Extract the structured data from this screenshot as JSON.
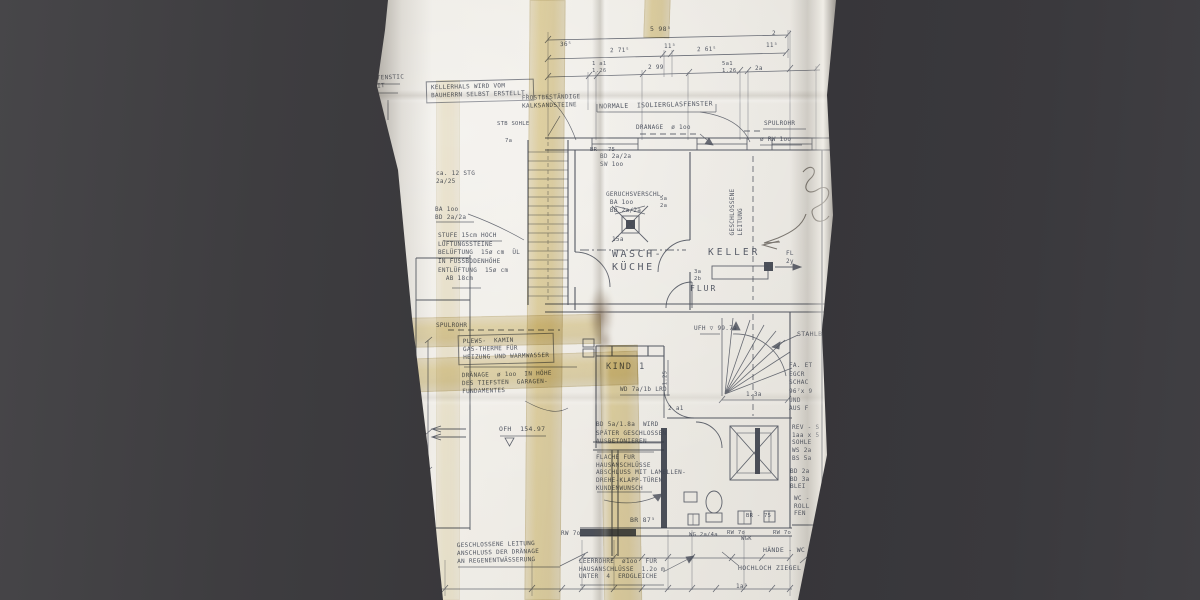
{
  "colors": {
    "backdrop": "#3a393c",
    "paper": "#e6e3dc",
    "tape": "#d2b36e",
    "ink": "#434855",
    "pencil": "#57514a"
  },
  "labels": {
    "kellerhals_note": "KELLERHALS WIRD VOM\nBAUHERRN SELBST ERSTELLT.",
    "edge_fragment": "TENSTIC\nIT",
    "frost_note": "FROSTBESTÄNDIGE\nKALKSANDSTEINE",
    "fenster_note": "NORMALE  ISOLIERGLASFENSTER",
    "drainage_top": "DRÄNAGE  ø 1oo",
    "spuelrohr_right": "SPÜLROHR",
    "rw100": "ø RW 1oo",
    "bd_sw": "BD 2a/2a\nSW 1oo",
    "br75_top": "BR - 75",
    "stg_note": "ca. 12 STG\n2a/25",
    "ba_bd": "BA 1oo\nBD 2a/2a",
    "stufe_note": "STUFE 15cm HOCH\nLÜFTUNGSSTEINE\nBELÜFTUNG  15ø cm  ÜL\nIN FUSSBODENHÖHE\nENTLÜFTUNG  15ø cm\n  AB 18cm",
    "geruch_note": "GERUCHSVERSCHL.\n BA 1oo\n BD 2a/2a",
    "sohle": "STB SOHLE",
    "dim_7a": "7a",
    "dim_15a": "15a",
    "wasch": "WASCH-\nKÜCHE",
    "keller": "KELLER",
    "geschl_leitung": "GESCHLOSSENE\nLEITUNG",
    "small_5a2a": "5a\n2a",
    "fl2y": "FL\n2y",
    "small_3a2b": "3a\n2b",
    "flur": "FLUR",
    "ufh": "UFH ▽ 99.7a",
    "stahlb": "STAHLB",
    "spuelrohr_left": "SPÜLROHR",
    "plews_note": "PLEWS-  KAMIN\nGAS-THERME FÜR\nHEIZUNG UND WARMWASSER",
    "drainage_note": "DRÄNAGE  ø 1oo  IN HÖHE\nDES TIEFSTEN  GARAGEN-\nFUNDAMENTES",
    "kind1": "KIND 1",
    "wd_lrd": "WD 7a/1b LRD",
    "dim_125": "1.25",
    "dim_2a1": "2 a1",
    "dim_13a": "1.3a",
    "bd5a_note": "BD 5a/1.8a  WIRD\nSPÄTER GESCHLOSSEN\nAUSBETONIEREN",
    "flaeche_note": "FLÄCHE FÜR\nHAUSANSCHLÜSSE\nABSCHLUSS MIT LAMELLEN-\nDREHE-KLAPP-TÜREN\nKUNDENWUNSCH",
    "br875": "BR 87⁵",
    "ofh": "OFH  154.97",
    "geschl_bottom": "GESCHLOSSENE LEITUNG\nANSCHLUSS DER DRÄNAGE\nAN REGENENTWÄSSERUNG",
    "rw7o_a": "RW 7o",
    "rw7o_b": "RW 7o",
    "rw7o_c": "RW 7o",
    "leerrohre_note": "LEERROHRE  ø1oo  FÜR\nHAUSANSCHLÜSSE  1.2o m\nUNTER  4  ERDGLEICHE",
    "wg2a4a": "WG 2a/4a",
    "wgk": "WGK",
    "haende_wc": "HÄNDE - WC",
    "hochloch": "HOCHLOCH ZIEGEL",
    "br75_bottom": "BR - 75",
    "col_a": "FA. ET\nEGCR\nSCHAC\n96⁷x 9\nUND\nAUS F",
    "col_b": "REV - S\n1aa x 5\nSOHLE\nWS 2a\nBS 5a",
    "col_c": "BD 2a\nBD 3a\nBLEI",
    "col_d": "WC -\nROLL\nFEN"
  },
  "dims": {
    "total": "5 98⁵",
    "d36": "36⁵",
    "d271": "2 71⁵",
    "d11a": "11⁵",
    "d261": "2 61⁵",
    "d11b": "11⁵",
    "d2": "2",
    "d1a1": "1 a1\n1.26",
    "d299": "2 99",
    "d5a1": "5a1\n1.26",
    "d2a": "2a",
    "d1a5": "1a⁵",
    "v564": "5 64",
    "v485": "4 8⁵"
  }
}
